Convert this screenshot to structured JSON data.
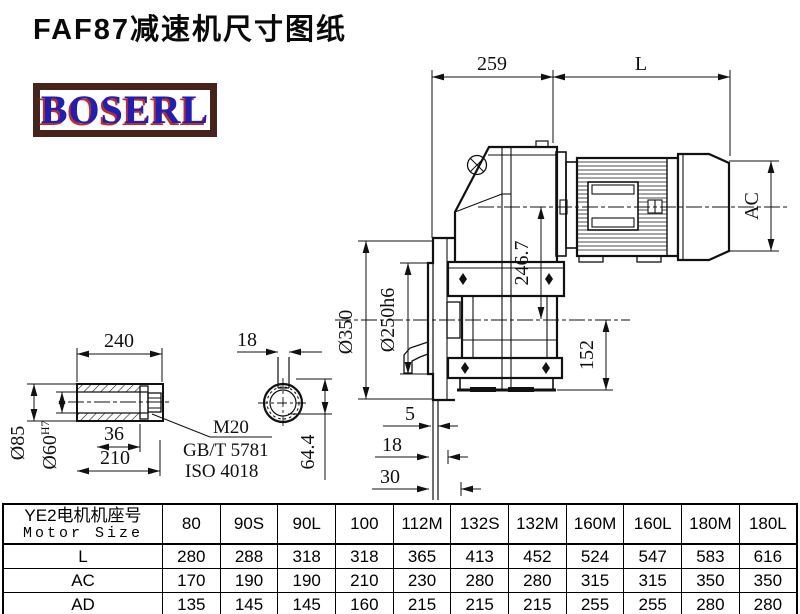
{
  "page": {
    "title": "FAF87减速机尺寸图纸",
    "logo": "BOSERL"
  },
  "drawing": {
    "dims": {
      "overall_width": "259",
      "motor_length": "L",
      "motor_ac": "AC",
      "center_height": "246.7",
      "base_height": "152",
      "flange_od": "Ø350",
      "flange_spigot": "Ø250h6",
      "offset_5": "5",
      "offset_18": "18",
      "offset_30": "30",
      "shaft_length": "240",
      "shaft_od": "Ø85",
      "bore_dia": "Ø60",
      "bore_tol": "H7",
      "key_len": "36",
      "hub_len": "210",
      "keyway_width": "18",
      "keyway_height": "64.4",
      "bolt": "M20",
      "bolt_std1": "GB/T 5781",
      "bolt_std2": "ISO 4018"
    }
  },
  "table": {
    "header_cn": "YE2电机机座号",
    "header_en": "Motor Size",
    "sizes": [
      "80",
      "90S",
      "90L",
      "100",
      "112M",
      "132S",
      "132M",
      "160M",
      "160L",
      "180M",
      "180L"
    ],
    "rows": [
      {
        "label": "L",
        "values": [
          "280",
          "288",
          "318",
          "318",
          "365",
          "413",
          "452",
          "524",
          "547",
          "583",
          "616"
        ]
      },
      {
        "label": "AC",
        "values": [
          "170",
          "190",
          "190",
          "210",
          "230",
          "280",
          "280",
          "315",
          "315",
          "350",
          "350"
        ]
      },
      {
        "label": "AD",
        "values": [
          "135",
          "145",
          "145",
          "160",
          "215",
          "215",
          "215",
          "255",
          "255",
          "280",
          "280"
        ]
      }
    ]
  }
}
